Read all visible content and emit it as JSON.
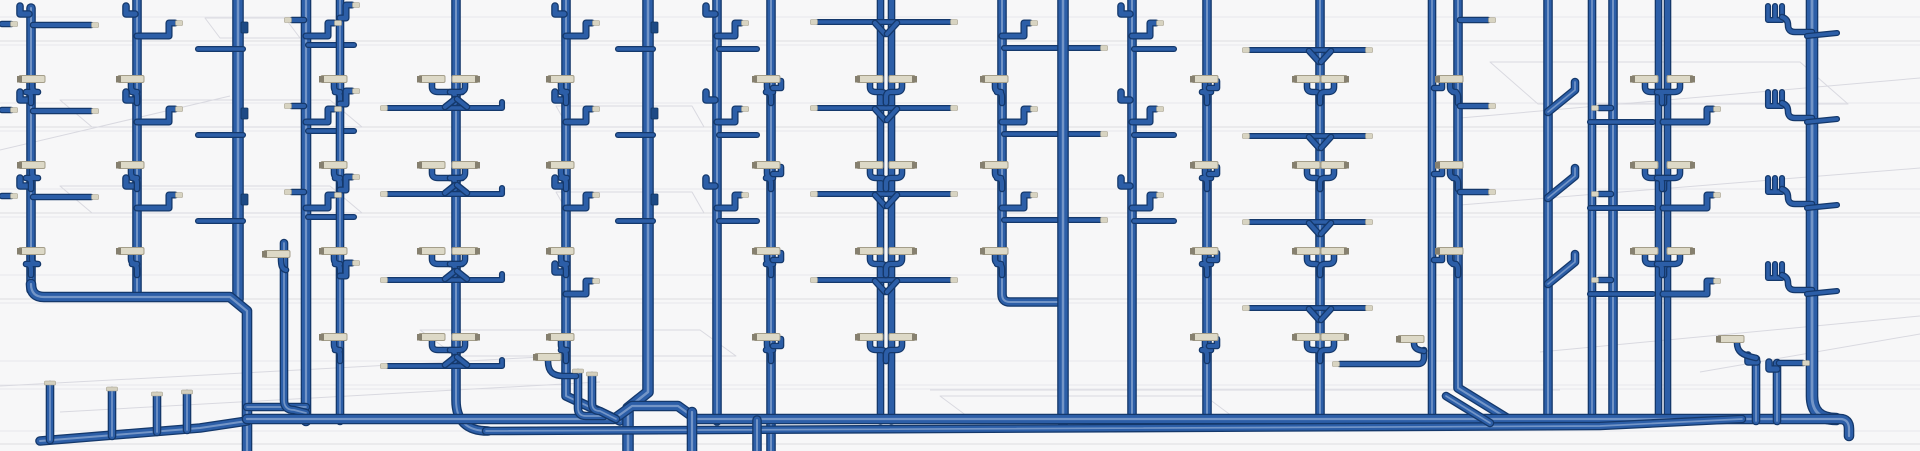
{
  "meta": {
    "canvas": {
      "w": 1920,
      "h": 451
    },
    "view_label": "3D plumbing riser piping view"
  },
  "palette": {
    "background": "#f7f7f8",
    "pipe_outline": "#14386b",
    "pipe_mid": "#2c5ea7",
    "pipe_highlight": "#7b9bcb",
    "fitting_fill": "#ddd9c7",
    "fitting_edge": "#a49e8a",
    "fitting_nub": "#86806f",
    "wireframe": "#d9d9e0",
    "floor_line": "#e7e7eb"
  },
  "floors": {
    "pitch": 86,
    "fitting_row_offset": 79,
    "arm_row_offset": 25,
    "thin_row_offset": 49
  },
  "background": {
    "floor_lines": [
      {
        "y": 17
      },
      {
        "y": 41,
        "dark": true
      },
      {
        "y": 45
      },
      {
        "y": 103
      },
      {
        "y": 127,
        "dark": true
      },
      {
        "y": 131
      },
      {
        "y": 189
      },
      {
        "y": 213,
        "dark": true
      },
      {
        "y": 217
      },
      {
        "y": 275
      },
      {
        "y": 299,
        "dark": true
      },
      {
        "y": 303
      },
      {
        "y": 361
      },
      {
        "y": 385
      },
      {
        "y": 389
      },
      {
        "y": 431
      },
      {
        "y": 444,
        "dark": true
      }
    ],
    "wire_paths": [
      "M60,100 L330,100 L362,127 L92,127 Z",
      "M205,18 L285,18 L300,38 L220,38 Z",
      "M556,106 L692,106 L704,127 L568,127 Z",
      "M60,186 L330,186 L362,213 L92,213 Z",
      "M556,192 L692,192 L704,213 L568,213 Z",
      "M420,330 L700,330 L736,356 L456,356 Z",
      "M940,396 L1205,396 L1240,422 L975,422 Z",
      "M1490,62 L1800,62 L1848,104 L1538,104 Z",
      "M0,386 L560,356",
      "M60,412 L600,382",
      "M0,150 L230,96",
      "M1460,118 L1920,78",
      "M1460,205 L1920,168",
      "M1540,352 L1920,316",
      "M1700,372 L1920,334",
      "M930,390 L1560,390"
    ]
  },
  "risers": [
    {
      "x": 31,
      "w": 7,
      "path": "M31,8 V290",
      "cycles": [
        0,
        1,
        2
      ],
      "comps": [
        {
          "t": "hookTL"
        },
        {
          "t": "armTipR",
          "y": 25,
          "len": 58
        },
        {
          "t": "fitL",
          "dx": 1
        }
      ]
    },
    {
      "x": 137,
      "w": 7,
      "path": "M137,-2 V297",
      "cycles": [
        0,
        1,
        2
      ],
      "comps": [
        {
          "t": "hookTL"
        },
        {
          "t": "armZR",
          "len": 40
        },
        {
          "t": "fitL",
          "dx": -6
        }
      ]
    },
    {
      "x": 238,
      "w": 9,
      "path": "M238,-2 V299",
      "cycles": [
        0,
        1,
        2
      ],
      "comps": [
        {
          "t": "tabR",
          "y": 22
        },
        {
          "t": "thinCrossL",
          "len": 40
        }
      ]
    },
    {
      "x": 306,
      "w": 8,
      "path": "M306,-2 V421",
      "cycles": [
        0,
        1,
        2
      ],
      "comps": [
        {
          "t": "armTipL",
          "y": 20,
          "len": 12
        },
        {
          "t": "armZR",
          "len": 30
        },
        {
          "t": "thinR",
          "y": 45,
          "len": 46
        }
      ]
    },
    {
      "x": 340,
      "w": 6,
      "path": "M340,-2 V421",
      "cycles": [
        0,
        1,
        2,
        3
      ],
      "comps": [
        {
          "t": "fitL",
          "dx": -6
        },
        {
          "t": "armZR",
          "row": 18,
          "len": 14
        }
      ]
    },
    {
      "x": 456,
      "w": 7,
      "path": "M456,-2 V400 Q456,431 488,431",
      "cycles": [
        0,
        1,
        2,
        3
      ],
      "comps": [
        {
          "t": "fitL",
          "dx": -24,
          "cross": true
        },
        {
          "t": "fitR",
          "dx": 9,
          "cross": true
        },
        {
          "t": "yarmWide",
          "xl": -68,
          "xr": 46
        }
      ]
    },
    {
      "x": 566,
      "w": 7,
      "path": "M566,-2 V396 L620,421",
      "cycles": [
        0,
        1,
        2,
        3
      ],
      "comps": [
        {
          "t": "hookTL"
        },
        {
          "t": "fitL",
          "dx": -5
        },
        {
          "t": "armZR",
          "len": 28
        }
      ]
    },
    {
      "x": 648,
      "w": 9,
      "path": "M648,-2 V392 L628,408 V451",
      "cycles": [
        0,
        1,
        2
      ],
      "comps": [
        {
          "t": "tabR",
          "y": 22
        },
        {
          "t": "thinCrossL",
          "len": 30
        }
      ]
    },
    {
      "x": 717,
      "w": 7,
      "path": "M717,-2 V421",
      "cycles": [
        0,
        1,
        2
      ],
      "comps": [
        {
          "t": "hookTL"
        },
        {
          "t": "armZR",
          "len": 26
        },
        {
          "t": "thinR",
          "y": 49,
          "len": 38
        }
      ]
    },
    {
      "x": 771,
      "w": 7,
      "path": "M771,-2 V451",
      "cycles": [
        0,
        1,
        2,
        3
      ],
      "comps": [
        {
          "t": "fitL",
          "dx": -4
        },
        {
          "t": "hookTabR",
          "y": 88
        }
      ]
    },
    {
      "x": 886,
      "w": 5,
      "dx2": 5.5,
      "path": "M886,-2 V421",
      "cycles": [
        0,
        1,
        2,
        3
      ],
      "comps": [
        {
          "t": "yarms",
          "y": 22,
          "xl": -68,
          "xr": 64
        },
        {
          "t": "fitL",
          "dx": -16
        },
        {
          "t": "fitR",
          "dx": 16
        }
      ]
    },
    {
      "x": 1002,
      "w": 7,
      "path": "M1002,-2 V294 Q1002,302 1010,302 H1063",
      "cycles": [
        0,
        1,
        2
      ],
      "comps": [
        {
          "t": "fitL",
          "dx": -7
        },
        {
          "t": "armZR",
          "len": 30
        },
        {
          "t": "thinR",
          "y": 48,
          "len": 96,
          "tip": true
        }
      ]
    },
    {
      "x": 1063,
      "w": 9,
      "path": "M1063,-2 V421",
      "cycles": [
        0,
        1,
        2
      ],
      "comps": []
    },
    {
      "x": 1132,
      "w": 7,
      "path": "M1132,-2 V421",
      "cycles": [
        0,
        1,
        2
      ],
      "comps": [
        {
          "t": "hookTL"
        },
        {
          "t": "armZR",
          "len": 26
        },
        {
          "t": "thinR",
          "y": 49,
          "len": 40
        }
      ]
    },
    {
      "x": 1207,
      "w": 7,
      "path": "M1207,-2 V421",
      "cycles": [
        0,
        1,
        2,
        3
      ],
      "comps": [
        {
          "t": "fitL",
          "dx": -2
        },
        {
          "t": "hookTabR",
          "y": 88
        }
      ]
    },
    {
      "x": 1320,
      "w": 7,
      "path": "M1320,-2 V421",
      "cycles": [
        0,
        1,
        2,
        3
      ],
      "comps": [
        {
          "t": "yarms",
          "y": 50,
          "xl": -70,
          "xr": 45
        },
        {
          "t": "fitL",
          "dx": -13
        },
        {
          "t": "fitR",
          "dx": 14
        }
      ]
    },
    {
      "x": 1432,
      "w": 6,
      "path": "M1432,-2 V421",
      "cycles": [
        0,
        1,
        2
      ],
      "comps": [
        {
          "t": "hookTabR",
          "y": 88
        }
      ]
    },
    {
      "x": 1458,
      "w": 7,
      "path": "M1458,-2 V388 L1510,420",
      "cycles": [
        0,
        1,
        2
      ],
      "comps": [
        {
          "t": "fitL",
          "dx": -8
        },
        {
          "t": "armTipR",
          "y": 20,
          "len": 28
        }
      ]
    },
    {
      "x": 1548,
      "w": 7,
      "path": "M1548,-2 V421",
      "cycles": [
        0,
        1,
        2
      ],
      "comps": [
        {
          "t": "jogR"
        }
      ]
    },
    {
      "x": 1592,
      "w": 6,
      "path": "M1592,-2 V421",
      "cycles": [
        0,
        1,
        2
      ],
      "comps": []
    },
    {
      "x": 1613,
      "w": 7,
      "path": "M1613,-2 V421",
      "cycles": [
        0,
        1,
        2
      ],
      "comps": [
        {
          "t": "armTipL",
          "y": 108,
          "len": 12
        },
        {
          "t": "thinCross",
          "y": 122,
          "x1": -23,
          "x2": 40
        }
      ]
    },
    {
      "x": 1663,
      "w": 5,
      "dx2": 4.5,
      "path": "M1663,-2 V419",
      "cycles": [
        0,
        1,
        2
      ],
      "comps": [
        {
          "t": "fitL",
          "dx": -18,
          "cross": true
        },
        {
          "t": "fitR",
          "dx": 17,
          "cross": true
        },
        {
          "t": "armZR",
          "row": 122,
          "len": 52
        }
      ]
    },
    {
      "x": 1812,
      "w": 10,
      "path": "M1812,-2 V396 Q1812,419 1836,419",
      "cycles": [
        0,
        1,
        2,
        3
      ],
      "comps": [
        {
          "t": "coilL",
          "dx": -44
        },
        {
          "t": "tickR"
        }
      ]
    }
  ],
  "bottom": {
    "pipes": [
      {
        "d": "M31,284 Q31,297 44,297 H230 L247,311 V451",
        "w": 8
      },
      {
        "d": "M247,407 H306",
        "w": 6
      },
      {
        "d": "M284,243 V400 Q284,410 294,410 L306,413",
        "w": 6
      },
      {
        "d": "M40,441 L200,428 L247,421",
        "w": 7
      },
      {
        "d": "M50,440 V385",
        "w": 6
      },
      {
        "d": "M112,436 V391",
        "w": 6
      },
      {
        "d": "M157,432 V396",
        "w": 6
      },
      {
        "d": "M187,430 V394",
        "w": 6
      },
      {
        "d": "M247,419 H614 L632,406 H678 L696,419 H1840 Q1849,419 1849,429 V436",
        "w": 8
      },
      {
        "d": "M486,431 L1600,426 L1742,419",
        "w": 6
      },
      {
        "d": "M692,412 V451",
        "w": 8
      },
      {
        "d": "M757,420 V451",
        "w": 7
      },
      {
        "d": "M578,373 V408 Q578,416 586,416 H604",
        "w": 6
      },
      {
        "d": "M592,376 V403 Q592,411 600,411 L616,419",
        "w": 6
      },
      {
        "d": "M548,361 C548,372 553,376 564,376 L576,376",
        "w": 4
      },
      {
        "d": "M1446,396 L1490,423",
        "w": 6
      },
      {
        "d": "M1756,359 V421",
        "w": 6
      },
      {
        "d": "M1757,362 H1748 V355",
        "w": 5
      },
      {
        "d": "M1737,343 C1737,352 1743,355 1752,357 L1756,358",
        "w": 4
      },
      {
        "d": "M1777,363 V421",
        "w": 6
      },
      {
        "d": "M1777,369 H1769 V362",
        "w": 5
      },
      {
        "d": "M1779,363 H1803",
        "w": 4
      },
      {
        "d": "M1340,364 H1418 Q1424,364 1424,357 V350",
        "w": 4
      },
      {
        "d": "M1414,343 C1414,349 1418,350 1424,351",
        "w": 4
      },
      {
        "d": "M281,258 C281,266 282,269 286,270",
        "w": 4
      },
      {
        "d": "M2,24 H11",
        "w": 4
      },
      {
        "d": "M2,110 H11",
        "w": 4
      },
      {
        "d": "M2,196 H11",
        "w": 4
      }
    ],
    "caps": [
      {
        "x": 50,
        "y": 384
      },
      {
        "x": 112,
        "y": 390
      },
      {
        "x": 157,
        "y": 395
      },
      {
        "x": 187,
        "y": 393
      },
      {
        "x": 578,
        "y": 372
      },
      {
        "x": 592,
        "y": 375
      }
    ]
  },
  "extra_fittings": [
    {
      "cx": 277,
      "cy": 254,
      "nub": "l"
    },
    {
      "cx": 548,
      "cy": 357,
      "nub": "l"
    },
    {
      "cx": 1731,
      "cy": 339,
      "nub": "l"
    },
    {
      "cx": 1411,
      "cy": 339,
      "nub": "l"
    }
  ],
  "extra_tips": [
    {
      "x": 14,
      "y": 24
    },
    {
      "x": 14,
      "y": 110
    },
    {
      "x": 14,
      "y": 196
    },
    {
      "x": 1806,
      "y": 363
    },
    {
      "x": 1336,
      "y": 364
    }
  ]
}
